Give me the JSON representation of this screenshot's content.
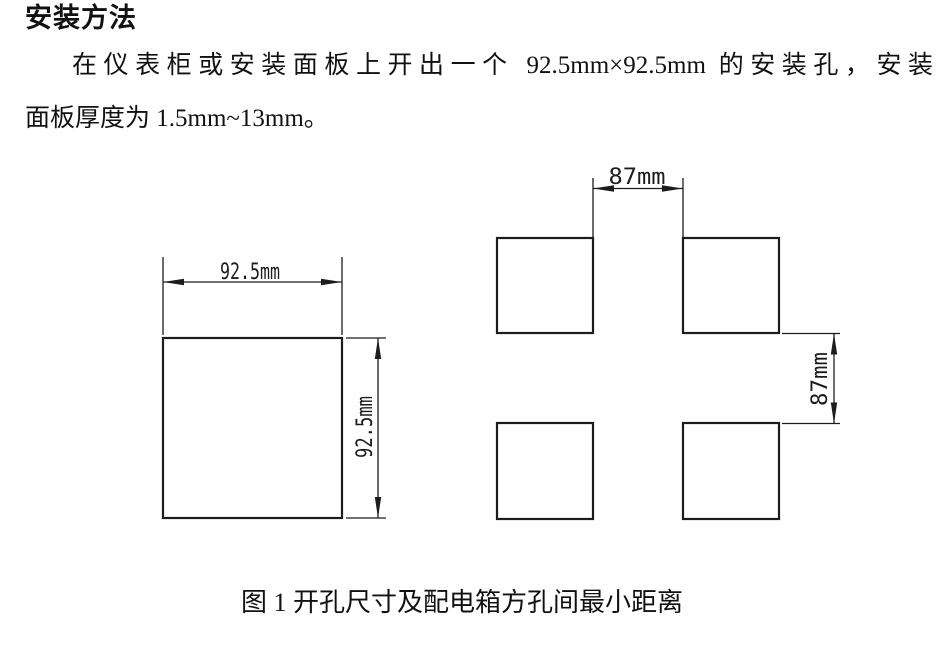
{
  "doc": {
    "heading": "安装方法",
    "paragraph_lines": [
      "在仪表柜或安装面板上开出一个 92.5mm×92.5mm 的安装孔，安装",
      "面板厚度为 1.5mm~13mm。"
    ]
  },
  "figure": {
    "caption": "图 1 开孔尺寸及配电箱方孔间最小距离",
    "left_cutout": {
      "width_label": "92.5mm",
      "height_label": "92.5mm"
    },
    "hole_spacing": {
      "horizontal_label": "87mm",
      "vertical_label": "87mm"
    }
  },
  "colors": {
    "ink": "#1c1c1c",
    "paper": "#ffffff"
  }
}
